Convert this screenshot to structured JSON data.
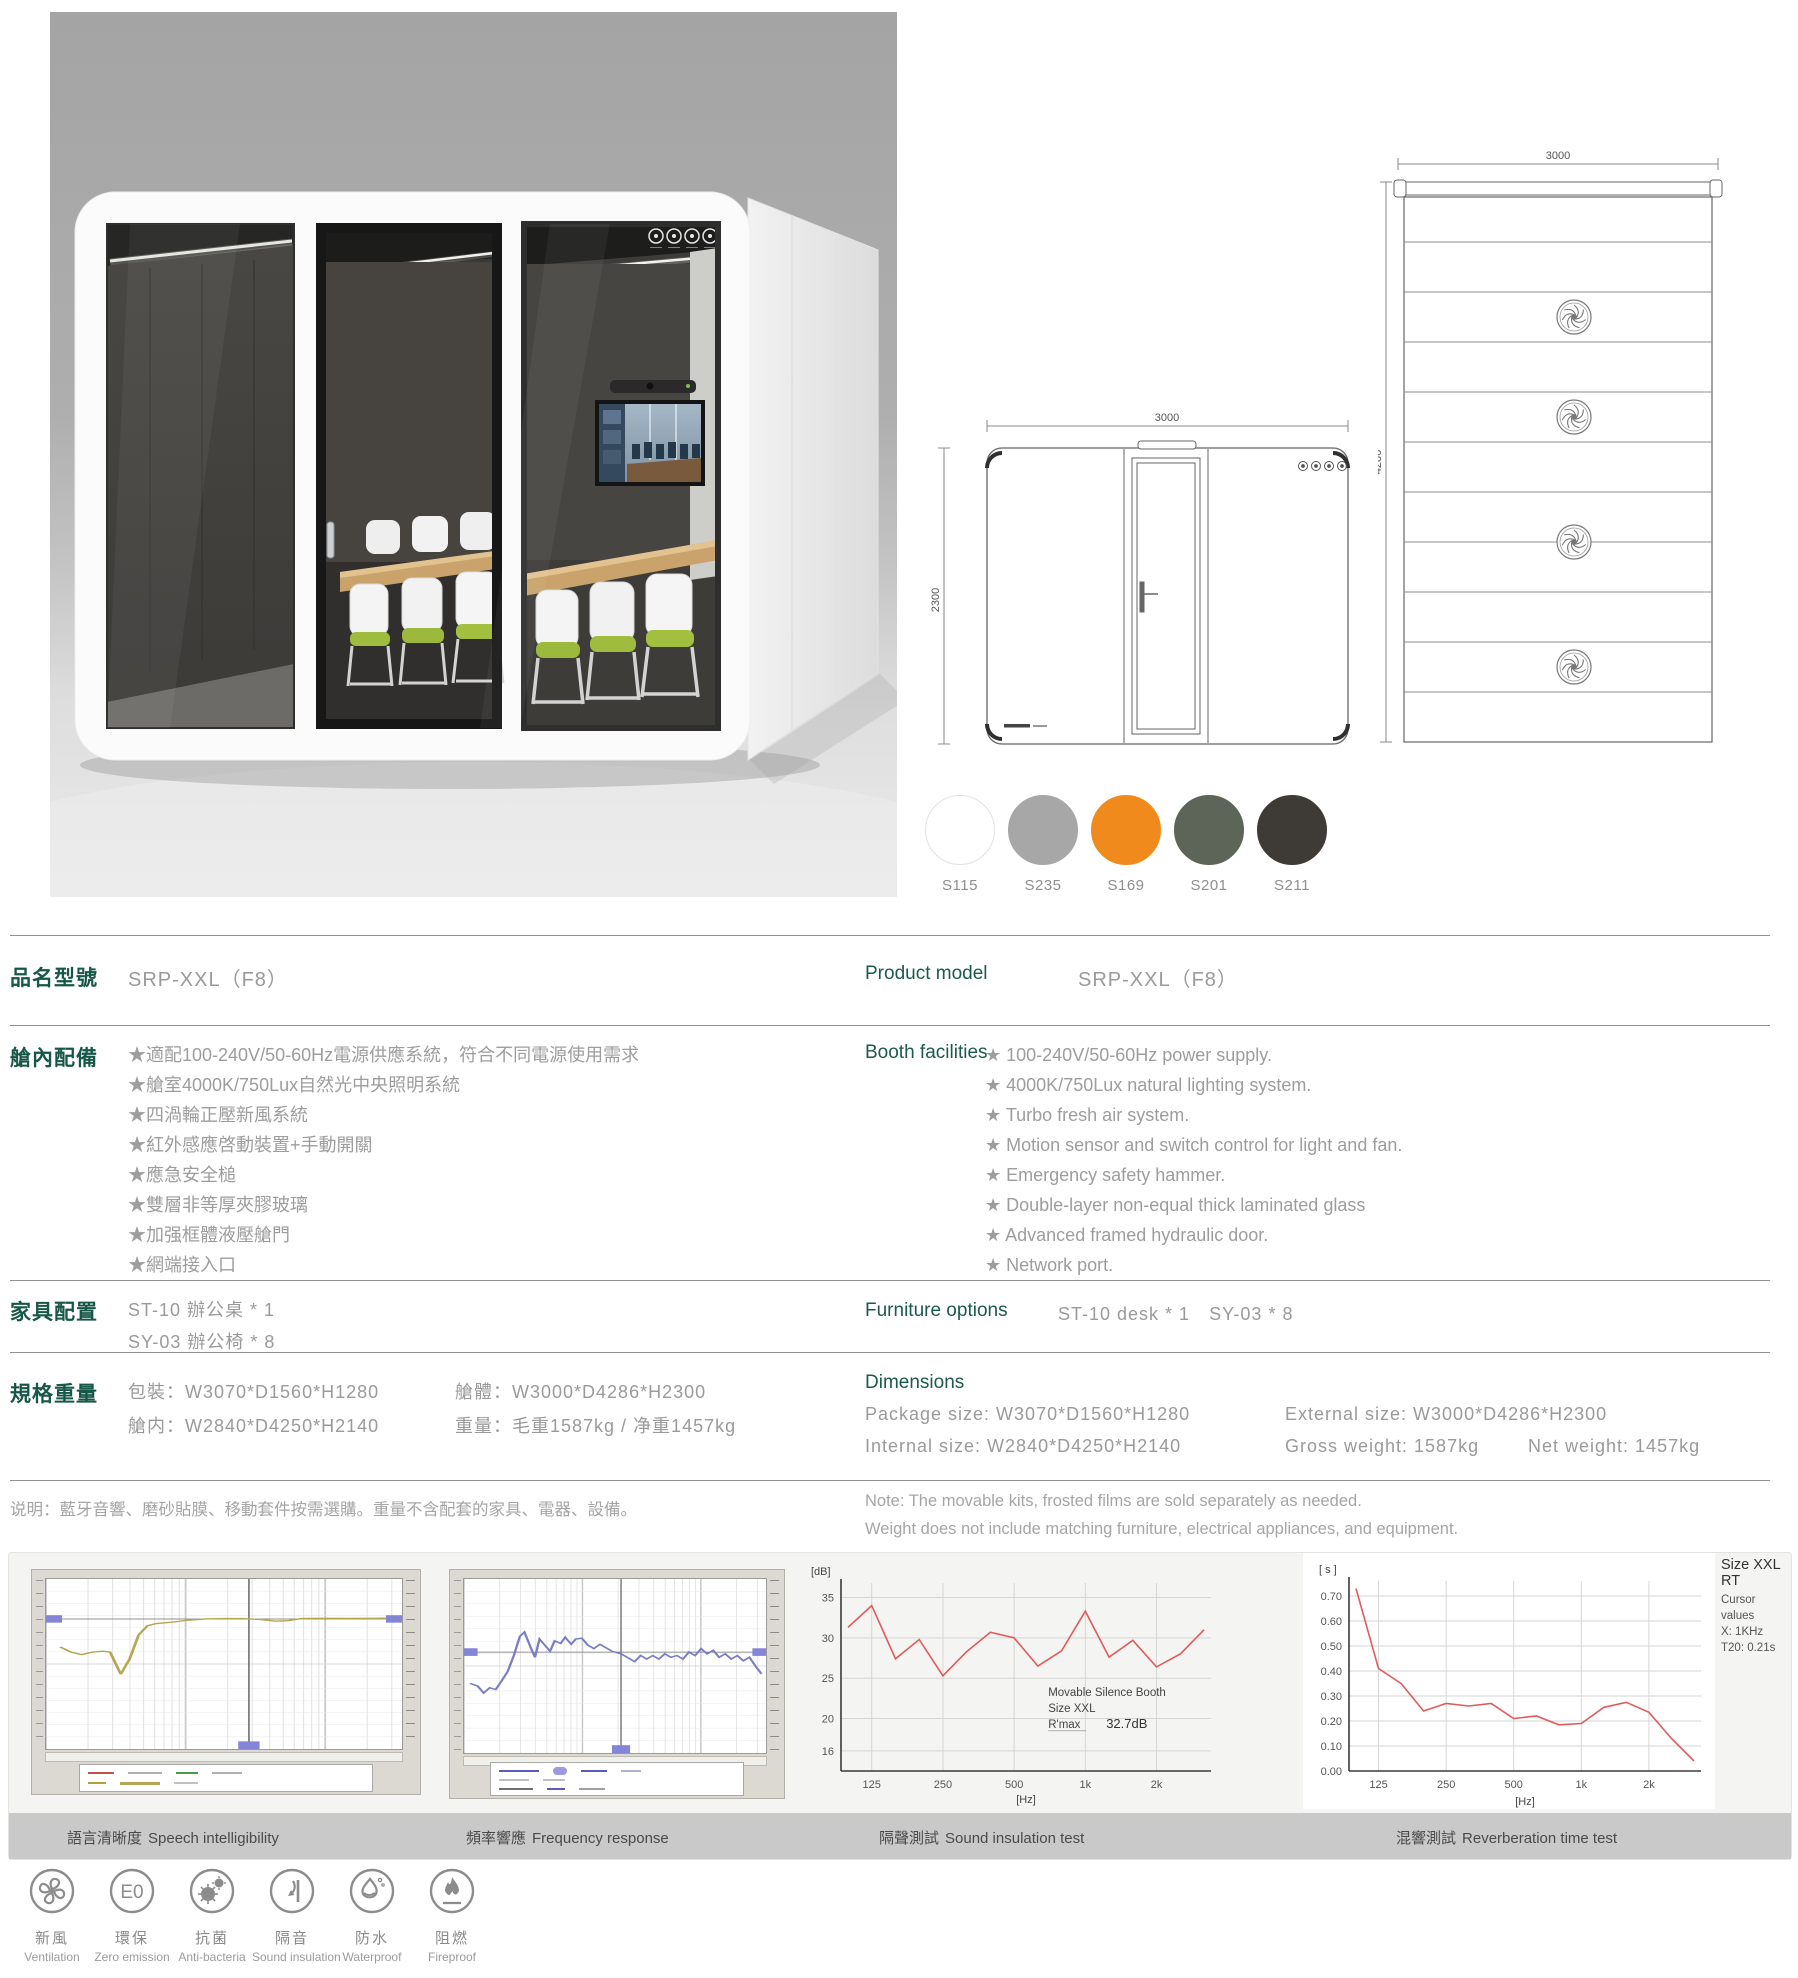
{
  "colors": {
    "heading": "#175748",
    "body_text": "#9a9a9a",
    "chart_red": "#e05c5c",
    "speech_line": "#b5a752",
    "freq_line": "#7a7ec2"
  },
  "swatches": [
    {
      "code": "S115",
      "color": "#ffffff",
      "border": "#e2e2e2"
    },
    {
      "code": "S235",
      "color": "#a7a7a7",
      "border": "#a7a7a7"
    },
    {
      "code": "S169",
      "color": "#f18a1d",
      "border": "#f18a1d"
    },
    {
      "code": "S201",
      "color": "#5d6458",
      "border": "#5d6458"
    },
    {
      "code": "S211",
      "color": "#3e3a36",
      "border": "#3e3a36"
    }
  ],
  "drawings": {
    "front_elevation": {
      "width": "3000",
      "height": "2300"
    },
    "plan_view": {
      "width": "3000",
      "depth": "4286"
    }
  },
  "specs": {
    "product_model": {
      "zh_label": "品名型號",
      "en_label": "Product model",
      "value": "SRP-XXL（F8）"
    },
    "booth": {
      "zh_label": "艙內配備",
      "en_label": "Booth facilities",
      "zh_items": [
        "★適配100-240V/50-60Hz電源供應系統，符合不同電源使用需求",
        "★艙室4000K/750Lux自然光中央照明系統",
        "★四渦輪正壓新風系統",
        "★紅外感應啓動裝置+手動開關",
        "★應急安全槌",
        "★雙層非等厚夾膠玻璃",
        "★加强框體液壓艙門",
        "★網端接入口"
      ],
      "en_items": [
        "★ 100-240V/50-60Hz power supply.",
        "★ 4000K/750Lux natural lighting system.",
        "★ Turbo fresh air system.",
        "★ Motion sensor and switch control for light and fan.",
        "★ Emergency safety hammer.",
        "★ Double-layer non-equal thick laminated glass",
        "★ Advanced framed hydraulic door.",
        "★ Network port."
      ]
    },
    "furniture": {
      "zh_label": "家具配置",
      "en_label": "Furniture options",
      "zh_line1": "ST-10 辦公桌 * 1",
      "zh_line2": "SY-03 辦公椅 * 8",
      "en_value": "ST-10 desk * 1　SY-03 * 8"
    },
    "dimensions": {
      "zh_label": "規格重量",
      "en_label": "Dimensions",
      "zh_package": "包裝：W3070*D1560*H1280",
      "zh_external": "艙體：W3000*D4286*H2300",
      "zh_internal": "艙内：W2840*D4250*H2140",
      "zh_weight": "重量：毛重1587kg / 净重1457kg",
      "en_package": "Package size: W3070*D1560*H1280",
      "en_external": "External size: W3000*D4286*H2300",
      "en_internal": "Internal size: W2840*D4250*H2140",
      "en_gross": "Gross weight: 1587kg",
      "en_net": "Net weight: 1457kg"
    },
    "note": {
      "zh": "说明：藍牙音響、磨砂貼膜、移動套件按需選購。重量不含配套的家具、電器、設備。",
      "en_line1": "Note:  The movable kits, frosted films are sold separately as needed.",
      "en_line2": "Weight does not include matching furniture, electrical appliances, and equipment."
    }
  },
  "chart_data": [
    {
      "type": "line",
      "title_zh": "語言清晰度",
      "title_en": "Speech intelligibility",
      "style": "measurement-software-screenshot",
      "line_color": "#b5a752",
      "cursor": {
        "x": 0.57,
        "y": 0.235
      },
      "points_norm": [
        [
          0.04,
          0.4
        ],
        [
          0.07,
          0.43
        ],
        [
          0.1,
          0.445
        ],
        [
          0.13,
          0.43
        ],
        [
          0.16,
          0.425
        ],
        [
          0.18,
          0.43
        ],
        [
          0.21,
          0.56
        ],
        [
          0.235,
          0.47
        ],
        [
          0.26,
          0.33
        ],
        [
          0.285,
          0.275
        ],
        [
          0.31,
          0.262
        ],
        [
          0.35,
          0.255
        ],
        [
          0.4,
          0.242
        ],
        [
          0.45,
          0.235
        ],
        [
          0.5,
          0.233
        ],
        [
          0.55,
          0.233
        ],
        [
          0.6,
          0.238
        ],
        [
          0.645,
          0.248
        ],
        [
          0.68,
          0.245
        ],
        [
          0.72,
          0.232
        ],
        [
          0.78,
          0.231
        ],
        [
          0.85,
          0.232
        ],
        [
          0.92,
          0.231
        ],
        [
          1.0,
          0.229
        ]
      ]
    },
    {
      "type": "line",
      "title_zh": "頻率響應",
      "title_en": "Frequency response",
      "style": "measurement-software-screenshot",
      "line_color": "#7a7ec2",
      "cursor": {
        "x": 0.52,
        "y": 0.42
      },
      "points_norm": [
        [
          0.02,
          0.6
        ],
        [
          0.045,
          0.615
        ],
        [
          0.065,
          0.655
        ],
        [
          0.085,
          0.625
        ],
        [
          0.105,
          0.635
        ],
        [
          0.125,
          0.585
        ],
        [
          0.145,
          0.53
        ],
        [
          0.165,
          0.44
        ],
        [
          0.185,
          0.33
        ],
        [
          0.2,
          0.305
        ],
        [
          0.22,
          0.39
        ],
        [
          0.235,
          0.45
        ],
        [
          0.25,
          0.345
        ],
        [
          0.265,
          0.375
        ],
        [
          0.285,
          0.415
        ],
        [
          0.3,
          0.355
        ],
        [
          0.32,
          0.37
        ],
        [
          0.335,
          0.335
        ],
        [
          0.355,
          0.375
        ],
        [
          0.37,
          0.345
        ],
        [
          0.39,
          0.34
        ],
        [
          0.41,
          0.38
        ],
        [
          0.43,
          0.4
        ],
        [
          0.45,
          0.375
        ],
        [
          0.47,
          0.395
        ],
        [
          0.49,
          0.415
        ],
        [
          0.52,
          0.43
        ],
        [
          0.545,
          0.455
        ],
        [
          0.565,
          0.475
        ],
        [
          0.585,
          0.44
        ],
        [
          0.605,
          0.46
        ],
        [
          0.625,
          0.44
        ],
        [
          0.645,
          0.46
        ],
        [
          0.665,
          0.43
        ],
        [
          0.685,
          0.45
        ],
        [
          0.705,
          0.44
        ],
        [
          0.725,
          0.46
        ],
        [
          0.745,
          0.42
        ],
        [
          0.765,
          0.44
        ],
        [
          0.785,
          0.4
        ],
        [
          0.805,
          0.43
        ],
        [
          0.825,
          0.41
        ],
        [
          0.845,
          0.45
        ],
        [
          0.865,
          0.43
        ],
        [
          0.885,
          0.46
        ],
        [
          0.905,
          0.44
        ],
        [
          0.925,
          0.47
        ],
        [
          0.945,
          0.45
        ],
        [
          0.965,
          0.5
        ],
        [
          0.985,
          0.545
        ]
      ]
    },
    {
      "type": "line",
      "title_zh": "隔聲測試",
      "title_en": "Sound insulation test",
      "line_color": "#e05c5c",
      "xlabel": "[Hz]",
      "ylabel": "[dB]",
      "bands": [
        100,
        125,
        160,
        200,
        250,
        315,
        400,
        500,
        630,
        800,
        1000,
        1250,
        1600,
        2000,
        2500,
        3150
      ],
      "values": [
        31.3,
        34.0,
        27.4,
        29.8,
        25.3,
        28.3,
        30.7,
        30.0,
        26.5,
        28.4,
        33.3,
        27.6,
        29.7,
        26.4,
        28.0,
        31.0
      ],
      "yticks": [
        "35",
        "30",
        "25",
        "20",
        "16"
      ],
      "xticks": [
        "125",
        "250",
        "500",
        "1k",
        "2k"
      ],
      "xtick_indices": [
        1,
        4,
        7,
        10,
        13
      ],
      "ylim": [
        13.5,
        36.8
      ],
      "annotation_lines": [
        "Movable Silence Booth",
        "Size XXL"
      ],
      "rmax_label": "R'max",
      "rmax_value": "32.7dB"
    },
    {
      "type": "line",
      "title_zh": "混響測試",
      "title_en": "Reverberation time test",
      "line_color": "#e05c5c",
      "xlabel": "[Hz]",
      "ylabel": "[ s ]",
      "bands": [
        100,
        125,
        160,
        200,
        250,
        315,
        400,
        500,
        630,
        800,
        1000,
        1250,
        1600,
        2000,
        2500,
        3150
      ],
      "values": [
        0.73,
        0.41,
        0.35,
        0.24,
        0.27,
        0.26,
        0.27,
        0.21,
        0.22,
        0.185,
        0.19,
        0.255,
        0.275,
        0.235,
        0.13,
        0.04
      ],
      "yticks": [
        "0.70",
        "0.60",
        "0.50",
        "0.40",
        "0.30",
        "0.20",
        "0.10",
        "0.00"
      ],
      "xticks": [
        "125",
        "250",
        "500",
        "1k",
        "2k"
      ],
      "xtick_indices": [
        1,
        4,
        7,
        10,
        13
      ],
      "ylim": [
        0,
        0.76
      ],
      "legend_title": "Size XXL RT",
      "legend_lines": [
        "Cursor values",
        "X: 1KHz",
        "T20: 0.21s"
      ]
    }
  ],
  "badges": [
    {
      "zh": "新風",
      "en": "Ventilation",
      "icon": "fan-icon"
    },
    {
      "zh": "環保",
      "en": "Zero emission",
      "icon": "e0-icon",
      "icon_text": "E0"
    },
    {
      "zh": "抗菌",
      "en": "Anti-bacteria",
      "icon": "bacteria-icon"
    },
    {
      "zh": "隔音",
      "en": "Sound insulation",
      "icon": "sound-insulation-icon"
    },
    {
      "zh": "防水",
      "en": "Waterproof",
      "icon": "waterproof-icon"
    },
    {
      "zh": "阻燃",
      "en": "Fireproof",
      "icon": "fireproof-icon"
    }
  ]
}
